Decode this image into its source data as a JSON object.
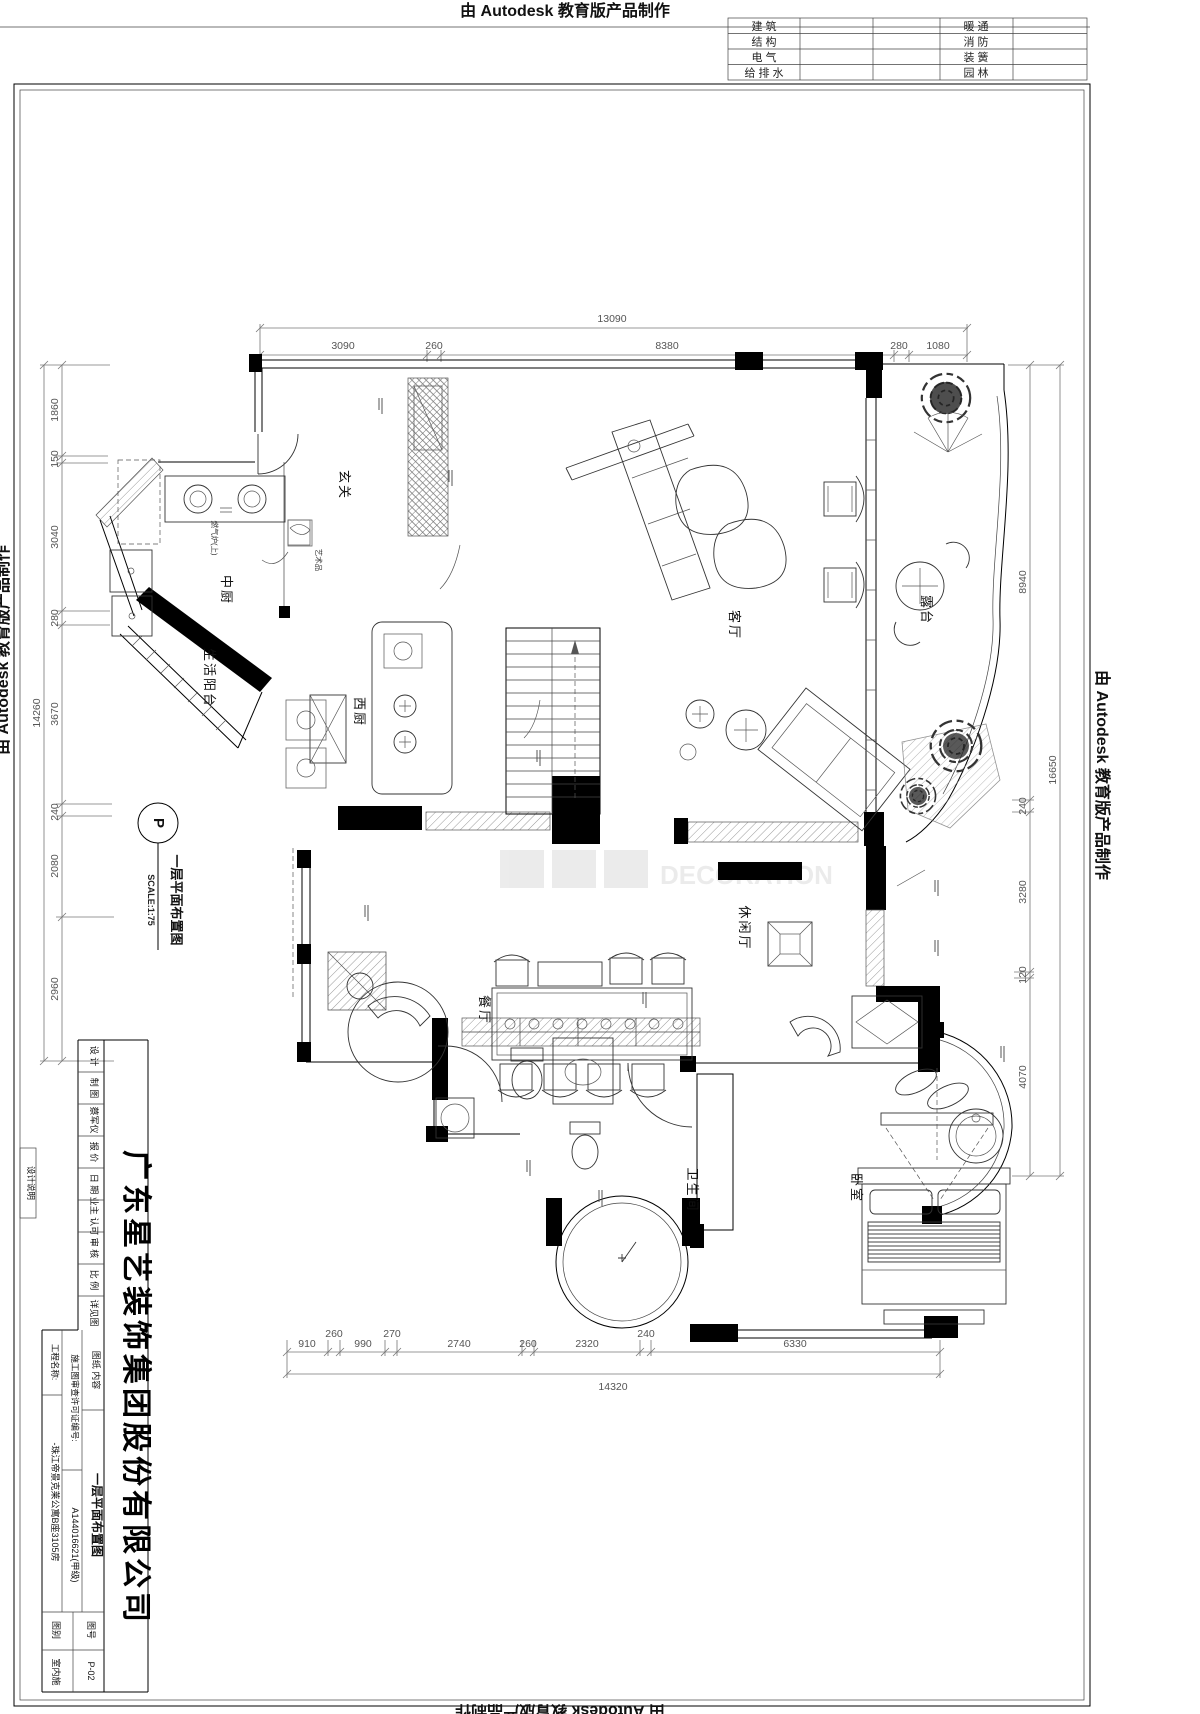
{
  "edge_marks": {
    "top": "由 Autodesk 教育版产品制作",
    "left": "由 Autodesk 教育版产品制作",
    "right": "由 Autodesk 教育版产品制作",
    "bottom": "由 Autodesk 教育版产品制作"
  },
  "discipline_table": {
    "rows": [
      {
        "c1": "建  筑",
        "c2": "暖  通"
      },
      {
        "c1": "结  构",
        "c2": "消  防"
      },
      {
        "c1": "电  气",
        "c2": "装  簧"
      },
      {
        "c1": "给 排 水",
        "c2": "园  林"
      }
    ]
  },
  "dims": {
    "top": {
      "total": "13090",
      "s": [
        "3090",
        "260",
        "8380",
        "280",
        "1080"
      ]
    },
    "bottom": {
      "total": "14320",
      "s": [
        "910",
        "260",
        "990",
        "270",
        "2740",
        "260",
        "2320",
        "240",
        "6330"
      ]
    },
    "left": {
      "total": "14260",
      "s": [
        "1860",
        "150",
        "3040",
        "280",
        "3670",
        "240",
        "2080",
        "2960"
      ]
    },
    "right": {
      "total": "16650",
      "s": [
        "8940",
        "240",
        "3280",
        "120",
        "4070"
      ]
    }
  },
  "rooms": {
    "entry": "玄关",
    "chinese_kitchen": "中厨",
    "service_balcony": "生活阳台",
    "western_kitchen": "西厨",
    "living": "客厅",
    "terrace": "露台",
    "dining": "餐厅",
    "lounge": "休闲厅",
    "bathroom": "卫生间",
    "bedroom": "卧室"
  },
  "marker": {
    "letter": "P",
    "title": "一层平面布置图",
    "scale": "SCALE:1:75"
  },
  "annotations": {
    "stove": "燃气炉(上)",
    "art": "艺术品"
  },
  "watermark_text": "DECORATION",
  "title_block": {
    "design_note": "设计说明",
    "company": "广东星艺装饰集团股份有限公司",
    "design": "设 计",
    "draft": "制 图",
    "drafter": "蔡军仪",
    "quote": "报 价",
    "date": "日 期",
    "owner_approve": "业主 认可",
    "audit": "审 核",
    "ratio": "比 例",
    "see_drawing": "详见图",
    "project_label": "工程名称:",
    "project_value": "-珠江帝景克莱公寓B座3105房",
    "permit_label": "施工图审查许可证编号:",
    "permit_value": "A144016621(甲级)",
    "content_label": "图纸 内容",
    "content_value": "一层平面布置图",
    "category_label": "图别",
    "category_value": "室内施",
    "no_label": "图号",
    "no_value": "P-02"
  }
}
